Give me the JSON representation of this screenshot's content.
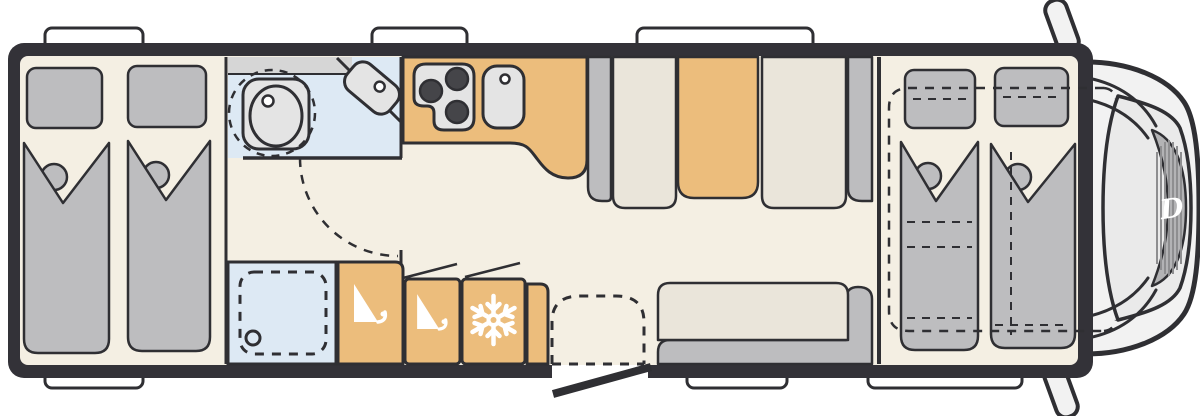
{
  "floorplan": {
    "kind": "motorhome-floorplan-top-view",
    "brand_logo_letter": "D",
    "window_tabs": {
      "top": 3,
      "bottom": 3
    },
    "entry_door_open": true,
    "icons": [
      "pillow",
      "duvet",
      "toilet-icon",
      "washbasin-icon",
      "shower-drain-icon",
      "stove-burners-icon",
      "kitchen-sink-icon",
      "hanger-icon",
      "hanger-icon",
      "snowflake-icon",
      "dinette-table",
      "bench-seat",
      "sofa",
      "drop-down-bed-dashed-outline",
      "entry-step",
      "door-swing-arc",
      "side-mirror",
      "windshield",
      "brand-logo"
    ],
    "colors": {
      "wall": "#333238",
      "floor": "#f4efe3",
      "upholstery": "#bdbdbf",
      "seat_cream": "#eae5da",
      "cabinet_tan": "#ecbd7c",
      "wet_room_blue": "#dde9f4",
      "fixture_gray": "#e4e4e4",
      "shelf_gray": "#d6d6d6",
      "cab_body": "#f2f2f2",
      "windshield": "#eaeaea",
      "dashboard": "#b3b3b5",
      "hatch": "#8e8e90",
      "outline": "#2f2f33",
      "window_white": "#ffffff",
      "icon_white": "#ffffff"
    }
  }
}
